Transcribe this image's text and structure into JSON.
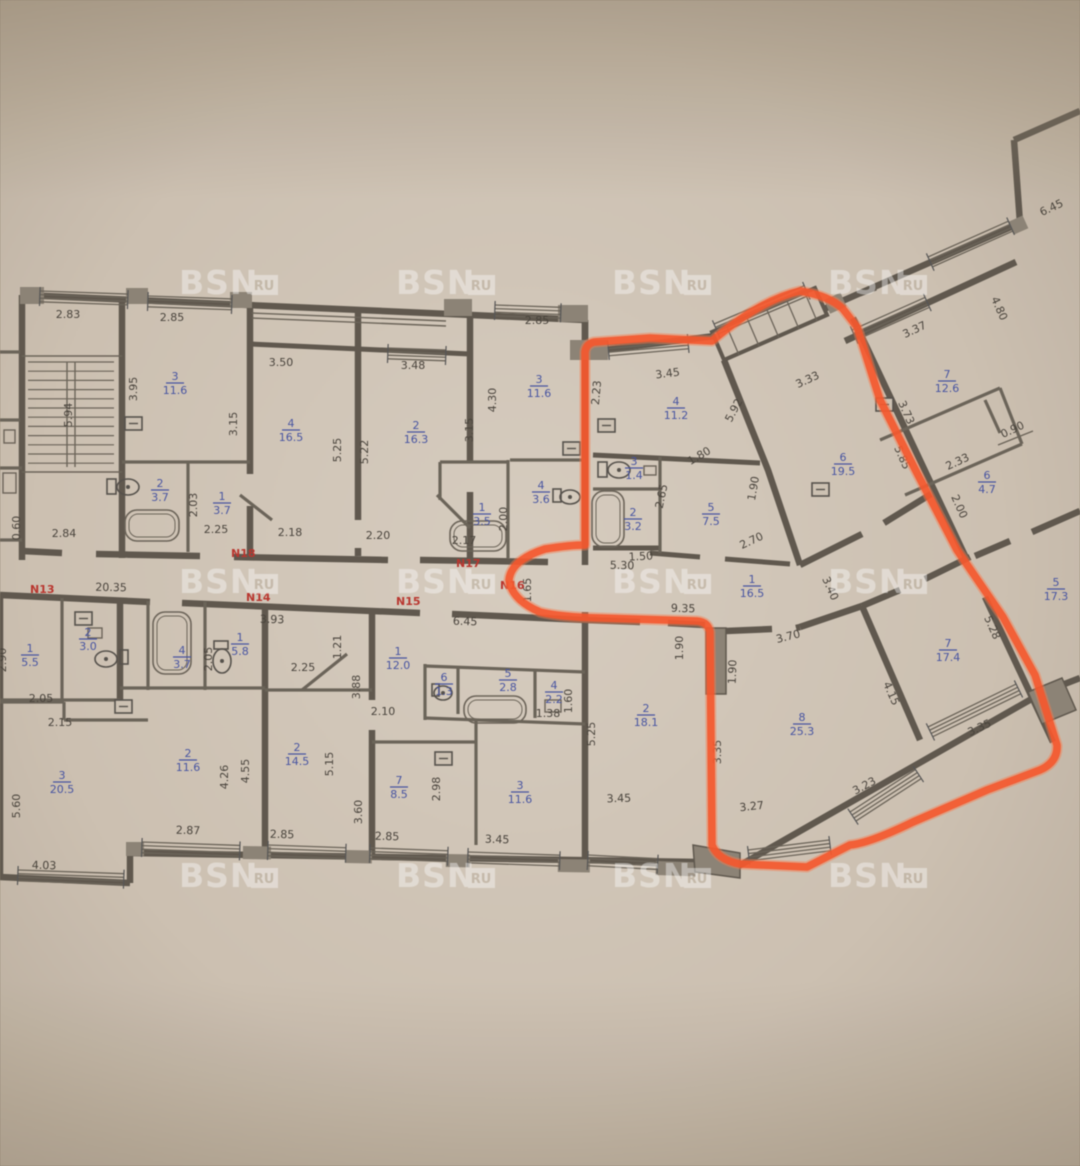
{
  "watermark": {
    "text": "BSN",
    "badge": "RU",
    "rows": [
      284,
      583,
      877
    ],
    "cols": [
      215,
      432,
      648,
      864
    ]
  },
  "colors": {
    "highlight": "#ff5326",
    "room_label": "#4553a6",
    "apartment_label": "#c0332b",
    "dimension": "#48423a",
    "wall": "#5f574c"
  },
  "apartment_numbers": [
    {
      "label": "N13",
      "x": 30,
      "y": 593
    },
    {
      "label": "N14",
      "x": 246,
      "y": 601
    },
    {
      "label": "N15",
      "x": 396,
      "y": 605
    },
    {
      "label": "N16",
      "x": 500,
      "y": 589
    },
    {
      "label": "N17",
      "x": 456,
      "y": 567
    },
    {
      "label": "N18",
      "x": 231,
      "y": 557
    }
  ],
  "rooms": [
    {
      "num": "3",
      "area": "11.6",
      "x": 175,
      "y": 383
    },
    {
      "num": "2",
      "area": "3.7",
      "x": 160,
      "y": 490
    },
    {
      "num": "1",
      "area": "3.7",
      "x": 222,
      "y": 503
    },
    {
      "num": "4",
      "area": "16.5",
      "x": 291,
      "y": 430
    },
    {
      "num": "2",
      "area": "16.3",
      "x": 416,
      "y": 432
    },
    {
      "num": "3",
      "area": "11.6",
      "x": 539,
      "y": 386
    },
    {
      "num": "1",
      "area": "3.5",
      "x": 482,
      "y": 514
    },
    {
      "num": "4",
      "area": "3.6",
      "x": 541,
      "y": 492
    },
    {
      "num": "4",
      "area": "11.2",
      "x": 676,
      "y": 408
    },
    {
      "num": "3",
      "area": "1.4",
      "x": 634,
      "y": 468
    },
    {
      "num": "2",
      "area": "3.2",
      "x": 633,
      "y": 519
    },
    {
      "num": "5",
      "area": "7.5",
      "x": 711,
      "y": 514
    },
    {
      "num": "6",
      "area": "19.5",
      "x": 843,
      "y": 464
    },
    {
      "num": "1",
      "area": "16.5",
      "x": 752,
      "y": 586
    },
    {
      "num": "7",
      "area": "12.6",
      "x": 947,
      "y": 381
    },
    {
      "num": "6",
      "area": "4.7",
      "x": 987,
      "y": 482
    },
    {
      "num": "5",
      "area": "17.3",
      "x": 1056,
      "y": 589
    },
    {
      "num": "7",
      "area": "17.4",
      "x": 948,
      "y": 650
    },
    {
      "num": "8",
      "area": "25.3",
      "x": 802,
      "y": 724
    },
    {
      "num": "2",
      "area": "18.1",
      "x": 646,
      "y": 715
    },
    {
      "num": "1",
      "area": "5.5",
      "x": 30,
      "y": 655
    },
    {
      "num": "2",
      "area": "3.0",
      "x": 88,
      "y": 639
    },
    {
      "num": "4",
      "area": "3.7",
      "x": 182,
      "y": 657
    },
    {
      "num": "1",
      "area": "5.8",
      "x": 240,
      "y": 644
    },
    {
      "num": "3",
      "area": "20.5",
      "x": 62,
      "y": 782
    },
    {
      "num": "2",
      "area": "11.6",
      "x": 188,
      "y": 760
    },
    {
      "num": "2",
      "area": "14.5",
      "x": 297,
      "y": 754
    },
    {
      "num": "1",
      "area": "12.0",
      "x": 398,
      "y": 658
    },
    {
      "num": "6",
      "area": "1.3",
      "x": 444,
      "y": 684
    },
    {
      "num": "5",
      "area": "2.8",
      "x": 508,
      "y": 680
    },
    {
      "num": "4",
      "area": "2.2",
      "x": 554,
      "y": 692
    },
    {
      "num": "7",
      "area": "8.5",
      "x": 399,
      "y": 787
    },
    {
      "num": "3",
      "area": "11.6",
      "x": 520,
      "y": 792
    }
  ],
  "dimensions": [
    {
      "t": "2.83",
      "x": 68,
      "y": 318,
      "r": 0
    },
    {
      "t": "2.85",
      "x": 172,
      "y": 321,
      "r": 0
    },
    {
      "t": "3.50",
      "x": 281,
      "y": 366,
      "r": 0
    },
    {
      "t": "3.48",
      "x": 413,
      "y": 369,
      "r": 0
    },
    {
      "t": "2.85",
      "x": 537,
      "y": 324,
      "r": 0
    },
    {
      "t": "3.95",
      "x": 137,
      "y": 389,
      "r": -90
    },
    {
      "t": "5.94",
      "x": 72,
      "y": 415,
      "r": -90
    },
    {
      "t": "3.15",
      "x": 237,
      "y": 424,
      "r": -90
    },
    {
      "t": "5.25",
      "x": 341,
      "y": 450,
      "r": -90
    },
    {
      "t": "5.22",
      "x": 368,
      "y": 452,
      "r": -90
    },
    {
      "t": "3.15",
      "x": 473,
      "y": 430,
      "r": -90
    },
    {
      "t": "4.30",
      "x": 496,
      "y": 400,
      "r": -90
    },
    {
      "t": "0.60",
      "x": 20,
      "y": 528,
      "r": -90
    },
    {
      "t": "2.84",
      "x": 64,
      "y": 537,
      "r": 0
    },
    {
      "t": "2.03",
      "x": 197,
      "y": 505,
      "r": -90
    },
    {
      "t": "2.25",
      "x": 216,
      "y": 533,
      "r": 0
    },
    {
      "t": "2.18",
      "x": 290,
      "y": 536,
      "r": 0
    },
    {
      "t": "2.20",
      "x": 378,
      "y": 539,
      "r": 0
    },
    {
      "t": "2.17",
      "x": 464,
      "y": 544,
      "r": 0
    },
    {
      "t": "2.00",
      "x": 507,
      "y": 519,
      "r": -90
    },
    {
      "t": "3.45",
      "x": 668,
      "y": 377,
      "r": -7
    },
    {
      "t": "2.23",
      "x": 600,
      "y": 393,
      "r": -85
    },
    {
      "t": "2.65",
      "x": 665,
      "y": 497,
      "r": -78
    },
    {
      "t": "1.80",
      "x": 701,
      "y": 459,
      "r": -30
    },
    {
      "t": "5.92",
      "x": 737,
      "y": 412,
      "r": -62
    },
    {
      "t": "1.90",
      "x": 757,
      "y": 489,
      "r": -80
    },
    {
      "t": "1.50",
      "x": 641,
      "y": 560,
      "r": -3
    },
    {
      "t": "2.70",
      "x": 753,
      "y": 544,
      "r": -25
    },
    {
      "t": "5.30",
      "x": 622,
      "y": 569,
      "r": 1
    },
    {
      "t": "9.35",
      "x": 683,
      "y": 612,
      "r": 2
    },
    {
      "t": "1.65",
      "x": 531,
      "y": 590,
      "r": -90
    },
    {
      "t": "3.33",
      "x": 809,
      "y": 383,
      "r": -25
    },
    {
      "t": "3.37",
      "x": 916,
      "y": 333,
      "r": -25
    },
    {
      "t": "6.45",
      "x": 1053,
      "y": 211,
      "r": -25
    },
    {
      "t": "4.80",
      "x": 996,
      "y": 310,
      "r": 66
    },
    {
      "t": "3.73",
      "x": 903,
      "y": 414,
      "r": 66
    },
    {
      "t": "5.85",
      "x": 899,
      "y": 459,
      "r": 66
    },
    {
      "t": "2.33",
      "x": 959,
      "y": 465,
      "r": -25
    },
    {
      "t": "0.90",
      "x": 1014,
      "y": 433,
      "r": -25
    },
    {
      "t": "2.00",
      "x": 956,
      "y": 508,
      "r": 66
    },
    {
      "t": "3.40",
      "x": 827,
      "y": 590,
      "r": 66
    },
    {
      "t": "3.70",
      "x": 789,
      "y": 640,
      "r": -14
    },
    {
      "t": "1.90",
      "x": 736,
      "y": 672,
      "r": -88
    },
    {
      "t": "4.15",
      "x": 888,
      "y": 695,
      "r": 66
    },
    {
      "t": "5.28",
      "x": 989,
      "y": 629,
      "r": 66
    },
    {
      "t": "3.35",
      "x": 721,
      "y": 752,
      "r": -90
    },
    {
      "t": "3.35",
      "x": 981,
      "y": 731,
      "r": -25
    },
    {
      "t": "3.23",
      "x": 866,
      "y": 789,
      "r": -28
    },
    {
      "t": "3.27",
      "x": 752,
      "y": 810,
      "r": -6
    },
    {
      "t": "3.45",
      "x": 619,
      "y": 802,
      "r": -2
    },
    {
      "t": "20.35",
      "x": 111,
      "y": 591,
      "r": 1
    },
    {
      "t": "3.93",
      "x": 272,
      "y": 623,
      "r": 1
    },
    {
      "t": "6.45",
      "x": 465,
      "y": 625,
      "r": 2
    },
    {
      "t": "2.90",
      "x": 6,
      "y": 660,
      "r": -90
    },
    {
      "t": "2.05",
      "x": 212,
      "y": 659,
      "r": -90
    },
    {
      "t": "1.21",
      "x": 341,
      "y": 647,
      "r": -90
    },
    {
      "t": "2.25",
      "x": 303,
      "y": 671,
      "r": 0
    },
    {
      "t": "3.88",
      "x": 360,
      "y": 687,
      "r": -90
    },
    {
      "t": "1.90",
      "x": 683,
      "y": 648,
      "r": -90
    },
    {
      "t": "2.05",
      "x": 41,
      "y": 702,
      "r": 0
    },
    {
      "t": "2.15",
      "x": 60,
      "y": 726,
      "r": 0
    },
    {
      "t": "2.10",
      "x": 383,
      "y": 715,
      "r": 0
    },
    {
      "t": "1.38",
      "x": 548,
      "y": 717,
      "r": 0
    },
    {
      "t": "1.60",
      "x": 572,
      "y": 701,
      "r": -90
    },
    {
      "t": "5.25",
      "x": 595,
      "y": 734,
      "r": -90
    },
    {
      "t": "4.26",
      "x": 228,
      "y": 777,
      "r": -90
    },
    {
      "t": "4.55",
      "x": 249,
      "y": 771,
      "r": -90
    },
    {
      "t": "5.15",
      "x": 333,
      "y": 764,
      "r": -90
    },
    {
      "t": "2.98",
      "x": 440,
      "y": 789,
      "r": -90
    },
    {
      "t": "5.60",
      "x": 20,
      "y": 806,
      "r": -90
    },
    {
      "t": "3.60",
      "x": 362,
      "y": 812,
      "r": -90
    },
    {
      "t": "4.03",
      "x": 44,
      "y": 869,
      "r": 1
    },
    {
      "t": "2.87",
      "x": 188,
      "y": 834,
      "r": 1
    },
    {
      "t": "2.85",
      "x": 282,
      "y": 838,
      "r": 1
    },
    {
      "t": "2.85",
      "x": 387,
      "y": 840,
      "r": 1
    },
    {
      "t": "3.45",
      "x": 497,
      "y": 843,
      "r": 2
    }
  ]
}
